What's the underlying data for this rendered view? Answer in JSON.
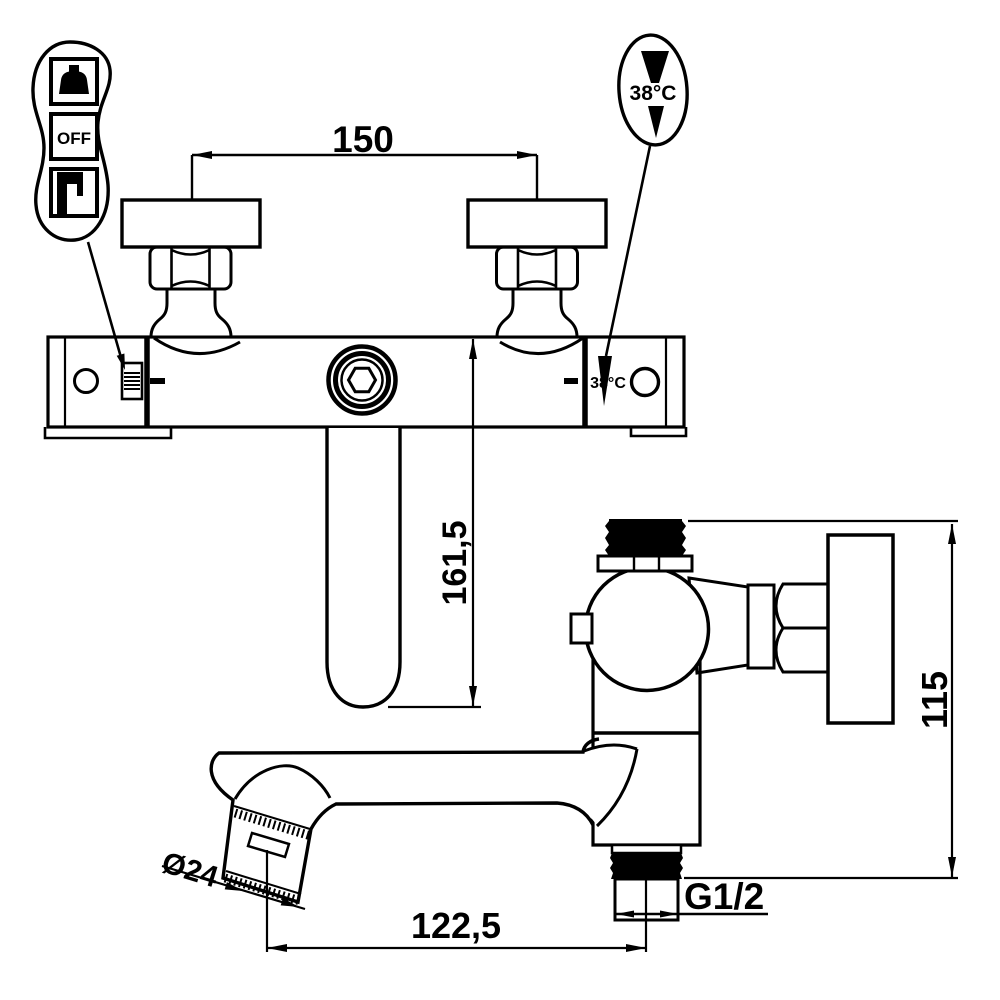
{
  "meta": {
    "drawing_type": "faucet installation dimension drawing",
    "background_color": "#ffffff",
    "line_color": "#000000"
  },
  "front_view": {
    "dim_width": "150",
    "dim_spout_drop": "161,5",
    "body_temp_label": "38°C",
    "mode_callout": {
      "off_label": "OFF",
      "icons": [
        "hand-shower-icon",
        "off-label",
        "tub-spout-icon"
      ]
    },
    "temp_callout": {
      "label": "38°C",
      "icons": [
        "temp-limit-wedge-up",
        "temp-limit-wedge-down"
      ]
    }
  },
  "side_view": {
    "dim_height": "115",
    "dim_reach": "122,5",
    "dim_aerator_diameter": "Ø24",
    "thread_label": "G1/2"
  }
}
